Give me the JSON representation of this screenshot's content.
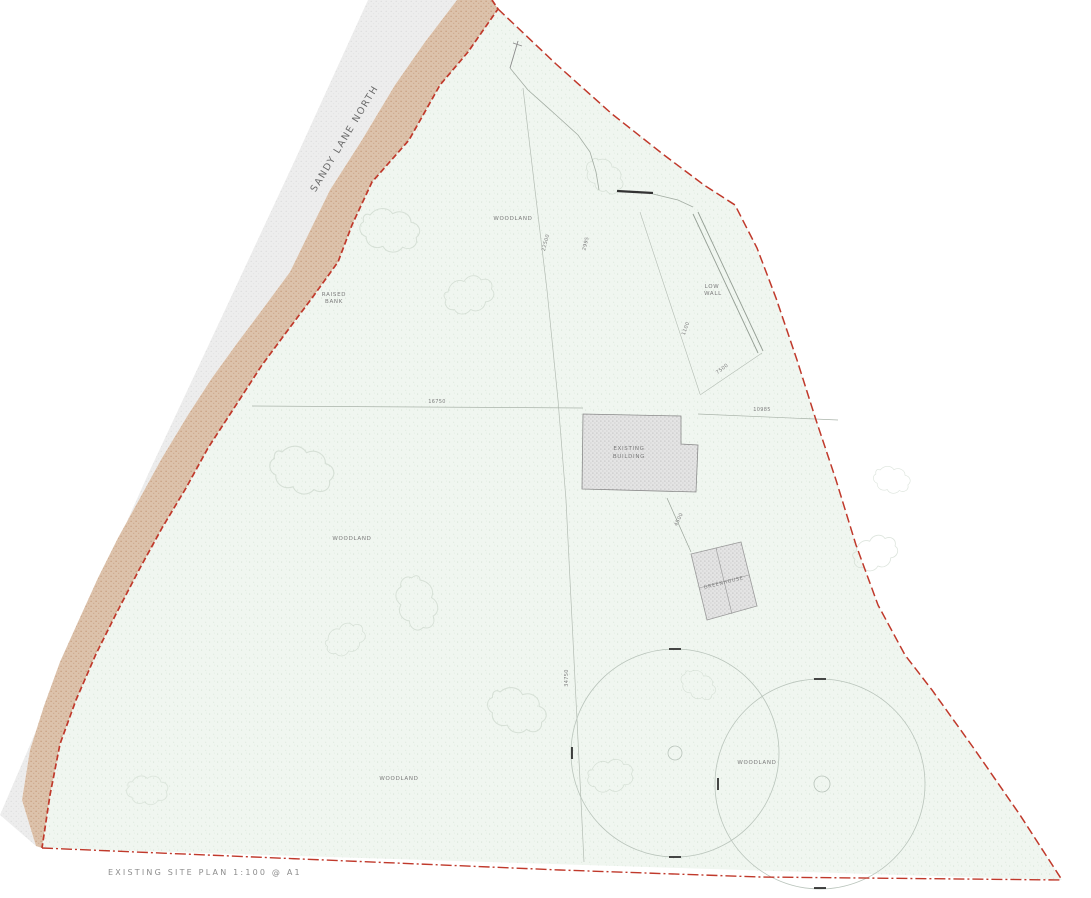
{
  "title": "EXISTING SITE PLAN 1:100 @ A1",
  "road": {
    "name": "SANDY LANE NORTH"
  },
  "bank": {
    "line1": "RAISED",
    "line2": "BANK"
  },
  "site": {
    "woodland_north": "WOODLAND",
    "woodland_west": "WOODLAND",
    "woodland_south": "WOODLAND",
    "woodland_east": "WOODLAND"
  },
  "features": {
    "low_wall": {
      "line1": "LOW",
      "line2": "WALL"
    },
    "building": {
      "line1": "EXISTING",
      "line2": "BUILDING"
    },
    "greenhouse": {
      "label": "GREENHOUSE"
    }
  },
  "dimensions": {
    "north_a": "22500",
    "north_b": "2995",
    "wall_offset": "1100",
    "wall_run": "7500",
    "building_west": "16750",
    "building_east": "10985",
    "greenhouse_link": "4500",
    "south_fence": "34750"
  },
  "colors": {
    "boundary_red": "#c0392b",
    "bank_tan": "#dcc2ab",
    "road_grey": "#ededed",
    "site_green": "#f0f6f0",
    "building_grey": "#e4e4e4"
  }
}
